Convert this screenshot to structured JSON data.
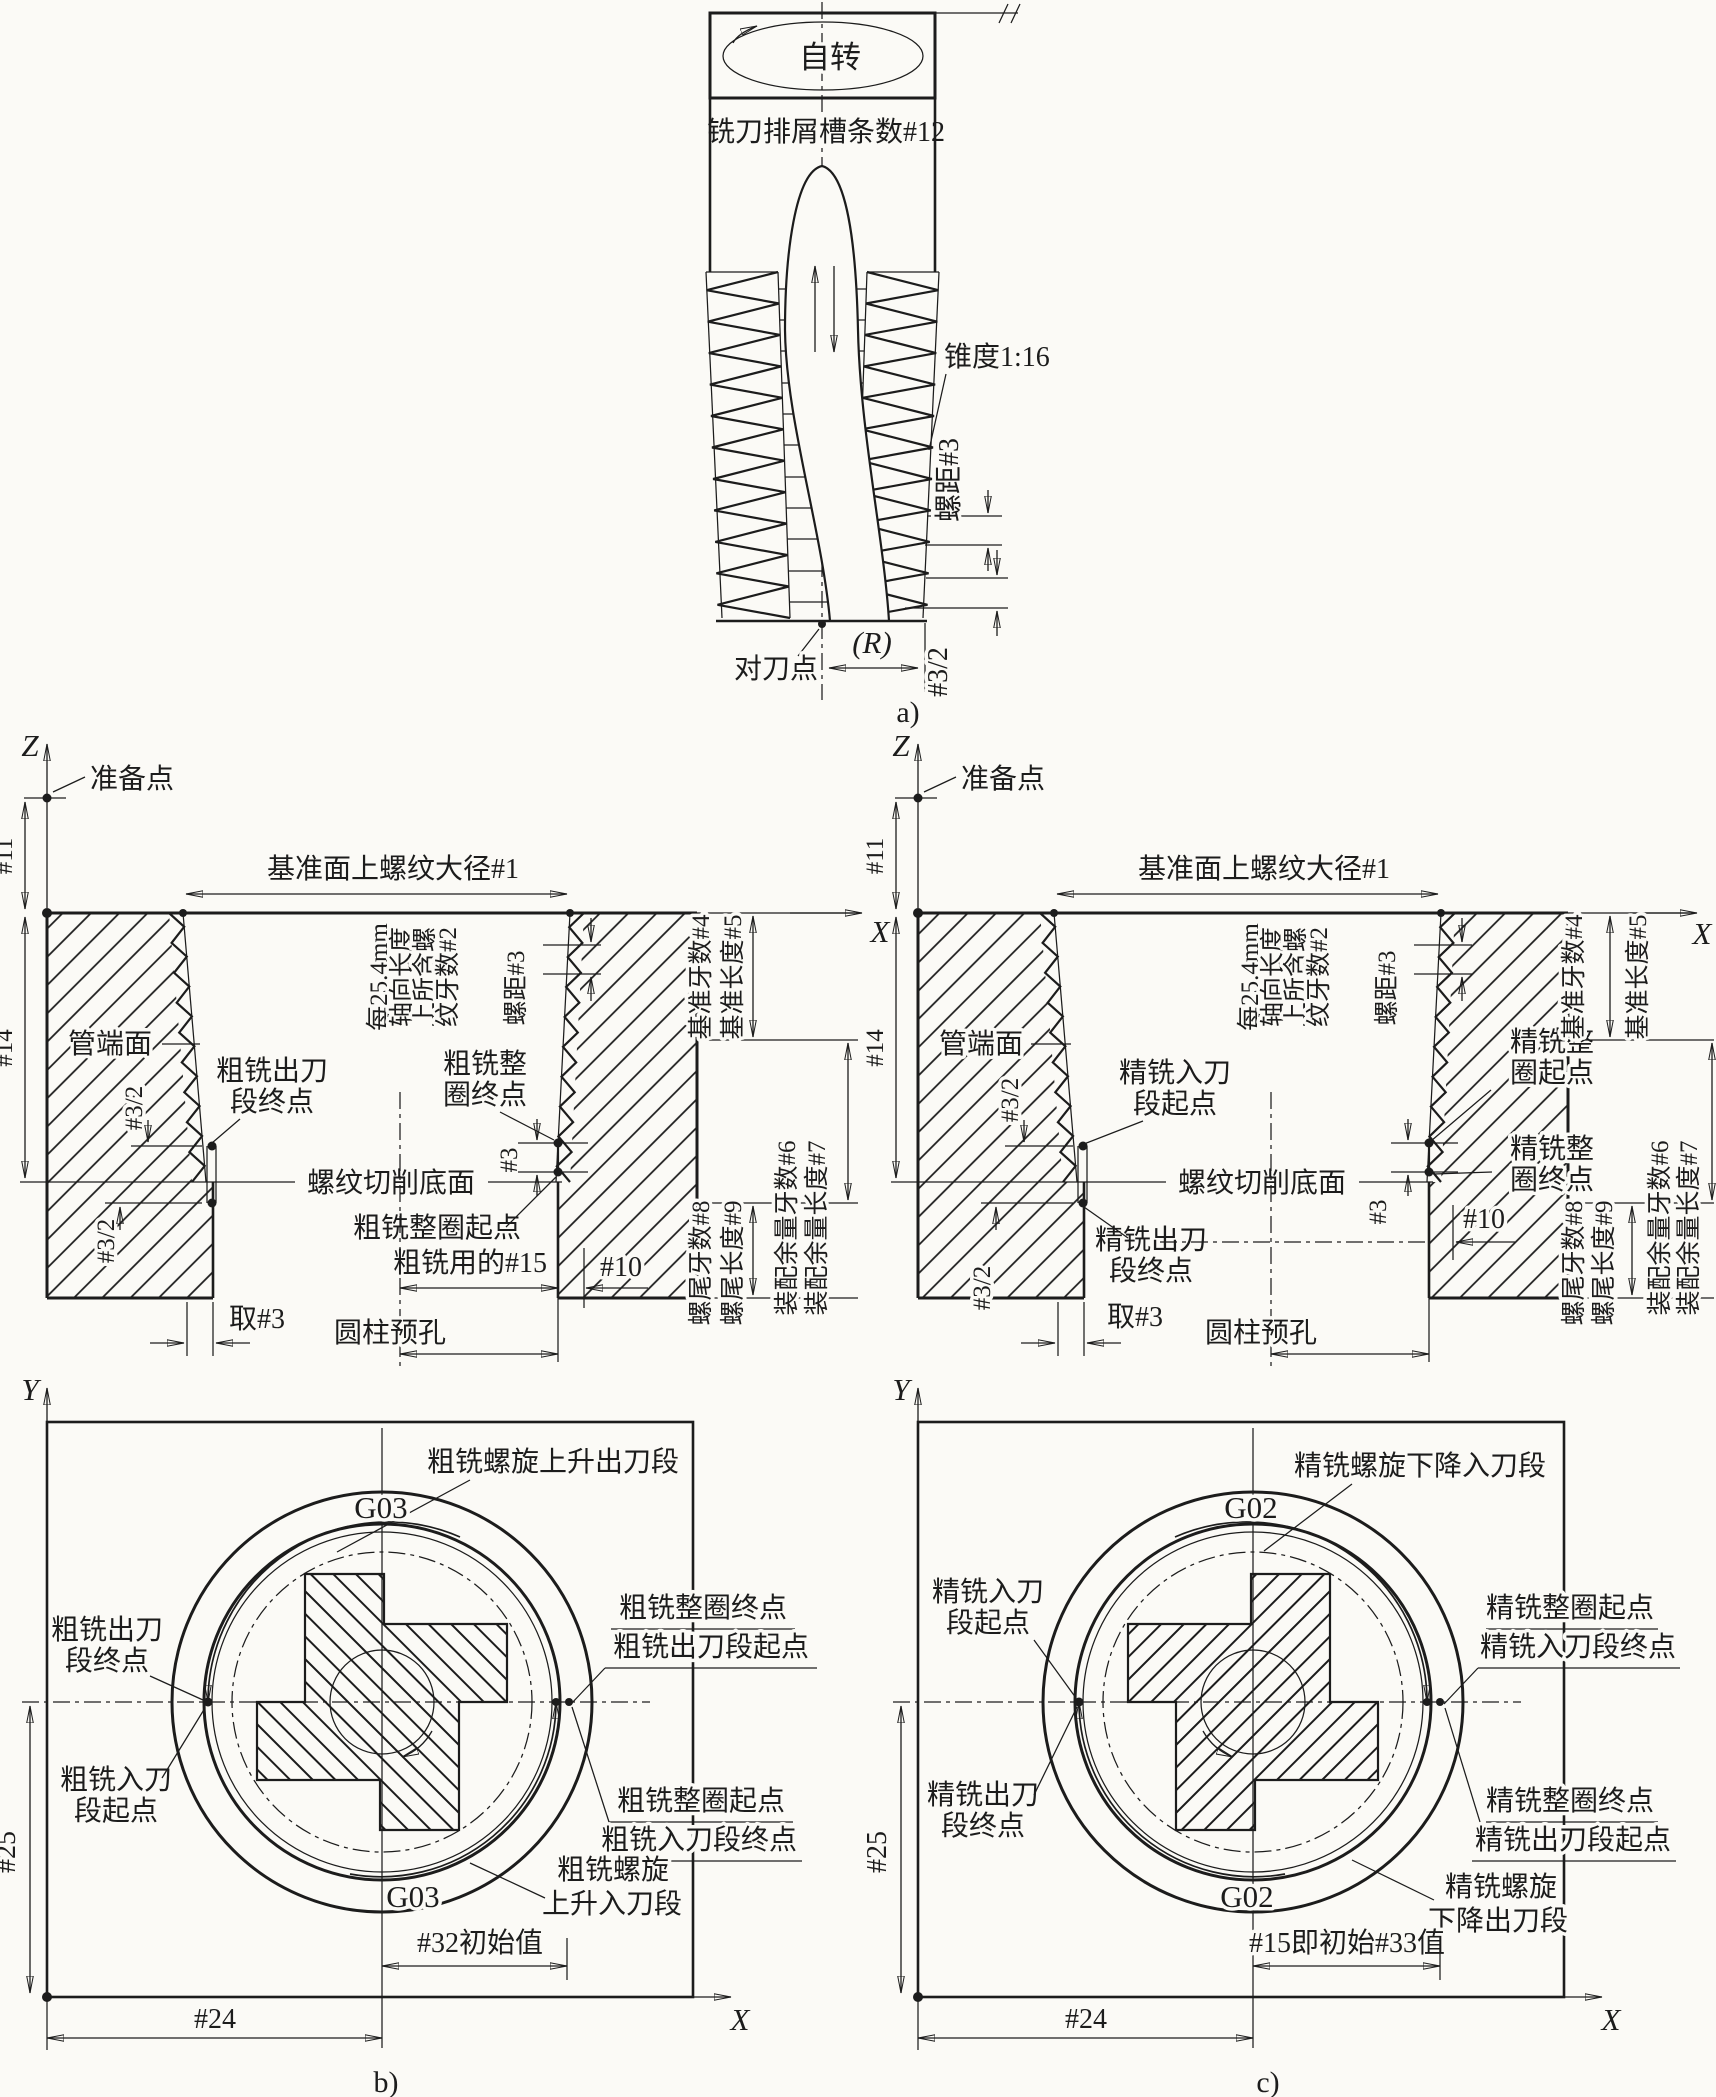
{
  "panel_a": {
    "caption": "a)",
    "rotation": "自转",
    "flutes": "铣刀排屑槽条数#12",
    "taper": "锥度1:16",
    "pitch": "螺距#3",
    "half_pitch": "#3/2",
    "radius": "(R)",
    "tool_point": "对刀点"
  },
  "section_b": {
    "z": "Z",
    "x": "X",
    "prep_point": "准备点",
    "dim11": "#11",
    "dim14": "#14",
    "major_dia": "基准面上螺纹大径#1",
    "teeth_per_inch": [
      "每25.4mm",
      "轴向长度",
      "上所含螺",
      "纹牙数#2"
    ],
    "pitch": "螺距#3",
    "pipe_end": "管端面",
    "exit_end": [
      "粗铣出刀",
      "段终点"
    ],
    "full_end": [
      "粗铣整",
      "圈终点"
    ],
    "bottom_face": "螺纹切削底面",
    "full_start": "粗铣整圈起点",
    "rough_15": "粗铣用的#15",
    "dim10": "#10",
    "dim3": "#3",
    "entry_start": [
      "粗铣入刀",
      "段起点"
    ],
    "half_pitch_u": "#3/2",
    "half_pitch_l": "#3/2",
    "take3": "取#3",
    "prehole": "圆柱预孔",
    "ref_teeth": "基准牙数#4",
    "ref_len": "基准长度#5",
    "tail_teeth": "螺尾牙数#8",
    "tail_len": "螺尾长度#9",
    "fit_teeth": "装配余量牙数#6",
    "fit_len": "装配余量长度#7"
  },
  "section_c": {
    "z": "Z",
    "x": "X",
    "prep_point": "准备点",
    "dim11": "#11",
    "dim14": "#14",
    "major_dia": "基准面上螺纹大径#1",
    "teeth_per_inch": [
      "每25.4mm",
      "轴向长度",
      "上所含螺",
      "纹牙数#2"
    ],
    "pitch": "螺距#3",
    "pipe_end": "管端面",
    "entry_start": [
      "精铣入刀",
      "段起点"
    ],
    "full_start": [
      "精铣整",
      "圈起点"
    ],
    "bottom_face": "螺纹切削底面",
    "full_end": [
      "精铣整",
      "圈终点"
    ],
    "exit_end": [
      "精铣出刀",
      "段终点"
    ],
    "dim10": "#10",
    "dim3": "#3",
    "half_pitch_u": "#3/2",
    "half_pitch_l": "#3/2",
    "take3": "取#3",
    "prehole": "圆柱预孔",
    "ref_teeth": "基准牙数#4",
    "ref_len": "基准长度#5",
    "tail_teeth": "螺尾牙数#8",
    "tail_len": "螺尾长度#9",
    "fit_teeth": "装配余量牙数#6",
    "fit_len": "装配余量长度#7"
  },
  "circle_b": {
    "y": "Y",
    "x": "X",
    "g_top": "G03",
    "g_bottom": "G03",
    "helix_exit": "粗铣螺旋上升出刀段",
    "exit_end": [
      "粗铣出刀",
      "段终点"
    ],
    "entry_start": [
      "粗铣入刀",
      "段起点"
    ],
    "full_end_exit_start": [
      "粗铣整圈终点",
      "粗铣出刀段起点"
    ],
    "full_start_entry_end": [
      "粗铣整圈起点",
      "粗铣入刀段终点"
    ],
    "helix_entry": [
      "粗铣螺旋",
      "上升入刀段"
    ],
    "init": "#32初始值",
    "dim24": "#24",
    "dim25": "#25",
    "caption": "b)"
  },
  "circle_c": {
    "y": "Y",
    "x": "X",
    "g_top": "G02",
    "g_bottom": "G02",
    "helix_entry": "精铣螺旋下降入刀段",
    "entry_start": [
      "精铣入刀",
      "段起点"
    ],
    "exit_end": [
      "精铣出刀",
      "段终点"
    ],
    "full_start_entry_end": [
      "精铣整圈起点",
      "精铣入刀段终点"
    ],
    "full_end_exit_start": [
      "精铣整圈终点",
      "精铣出刀段起点"
    ],
    "helix_exit": [
      "精铣螺旋",
      "下降出刀段"
    ],
    "init": "#15即初始#33值",
    "dim24": "#24",
    "dim25": "#25",
    "caption": "c)"
  }
}
